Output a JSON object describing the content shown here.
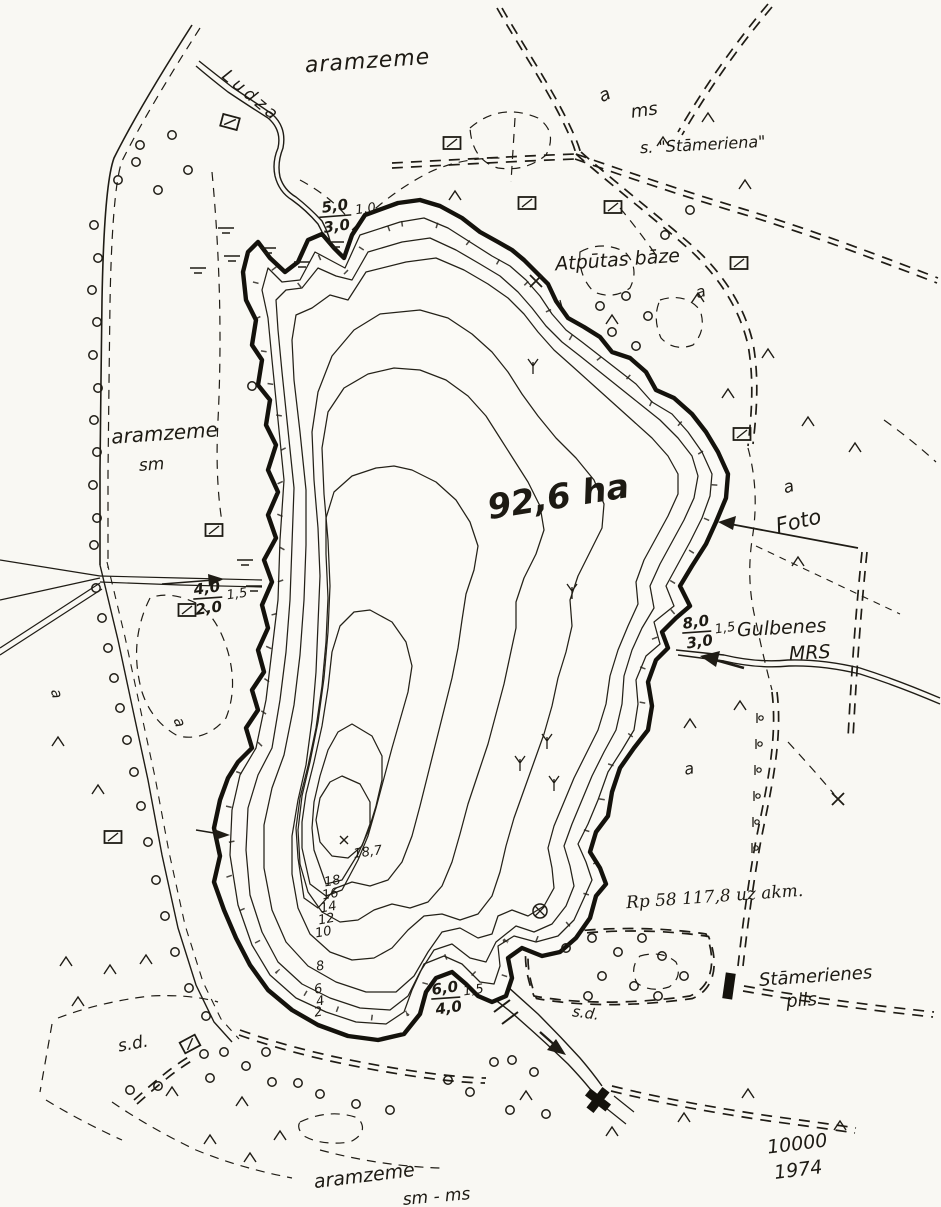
{
  "map": {
    "lake_area": "92,6 ha",
    "max_depth_point": "18,7",
    "scale": "10000",
    "year": "1974"
  },
  "labels": {
    "aramzeme": "aramzeme",
    "ludza_river": "Ludza",
    "a": "a",
    "ms": "ms",
    "settlement": "s. \"Stāmeriena\"",
    "atputas_baze": "Atpūtas bāze",
    "sm": "sm",
    "foto": "Foto",
    "gulbenes": "Gulbenes",
    "mrs": "MRS",
    "rp_note": "Rp 58  117,8 uz akm.",
    "pils_line1": "Stāmerienes",
    "pils_line2": "pils",
    "sd": "s.d.",
    "sm_ms": "sm - ms"
  },
  "depth_contour_labels": [
    "18",
    "16",
    "14",
    "12",
    "10",
    "8",
    "6",
    "4",
    "2"
  ],
  "stream_notes": {
    "north_inflow": {
      "num": "5,0",
      "den": "3,0",
      "side": "1,0"
    },
    "west_ditch": {
      "num": "4,0",
      "den": "2,0",
      "side": "1,5"
    },
    "east_inflow": {
      "num": "8,0",
      "den": "3,0",
      "side": "1,5"
    },
    "south_outlet": {
      "num": "6,0",
      "den": "4,0",
      "side": "1,5"
    }
  },
  "symbols_legend": {
    "building-icon": "open rectangle with slash",
    "filled-building-icon": "solid black rectangle",
    "orchard-tree-icon": "small circle",
    "scrub-icon": "caret",
    "marsh-icon": "double horizontal bar",
    "reed-icon": "three-pronged tuft",
    "cross-mark-icon": "x",
    "circled-cross-icon": "circle with x",
    "bridge-icon": "cross shape",
    "post-icon": "stem with circle"
  },
  "palette": {
    "ink": "#1f1c15",
    "paper": "#f9f8f3"
  }
}
